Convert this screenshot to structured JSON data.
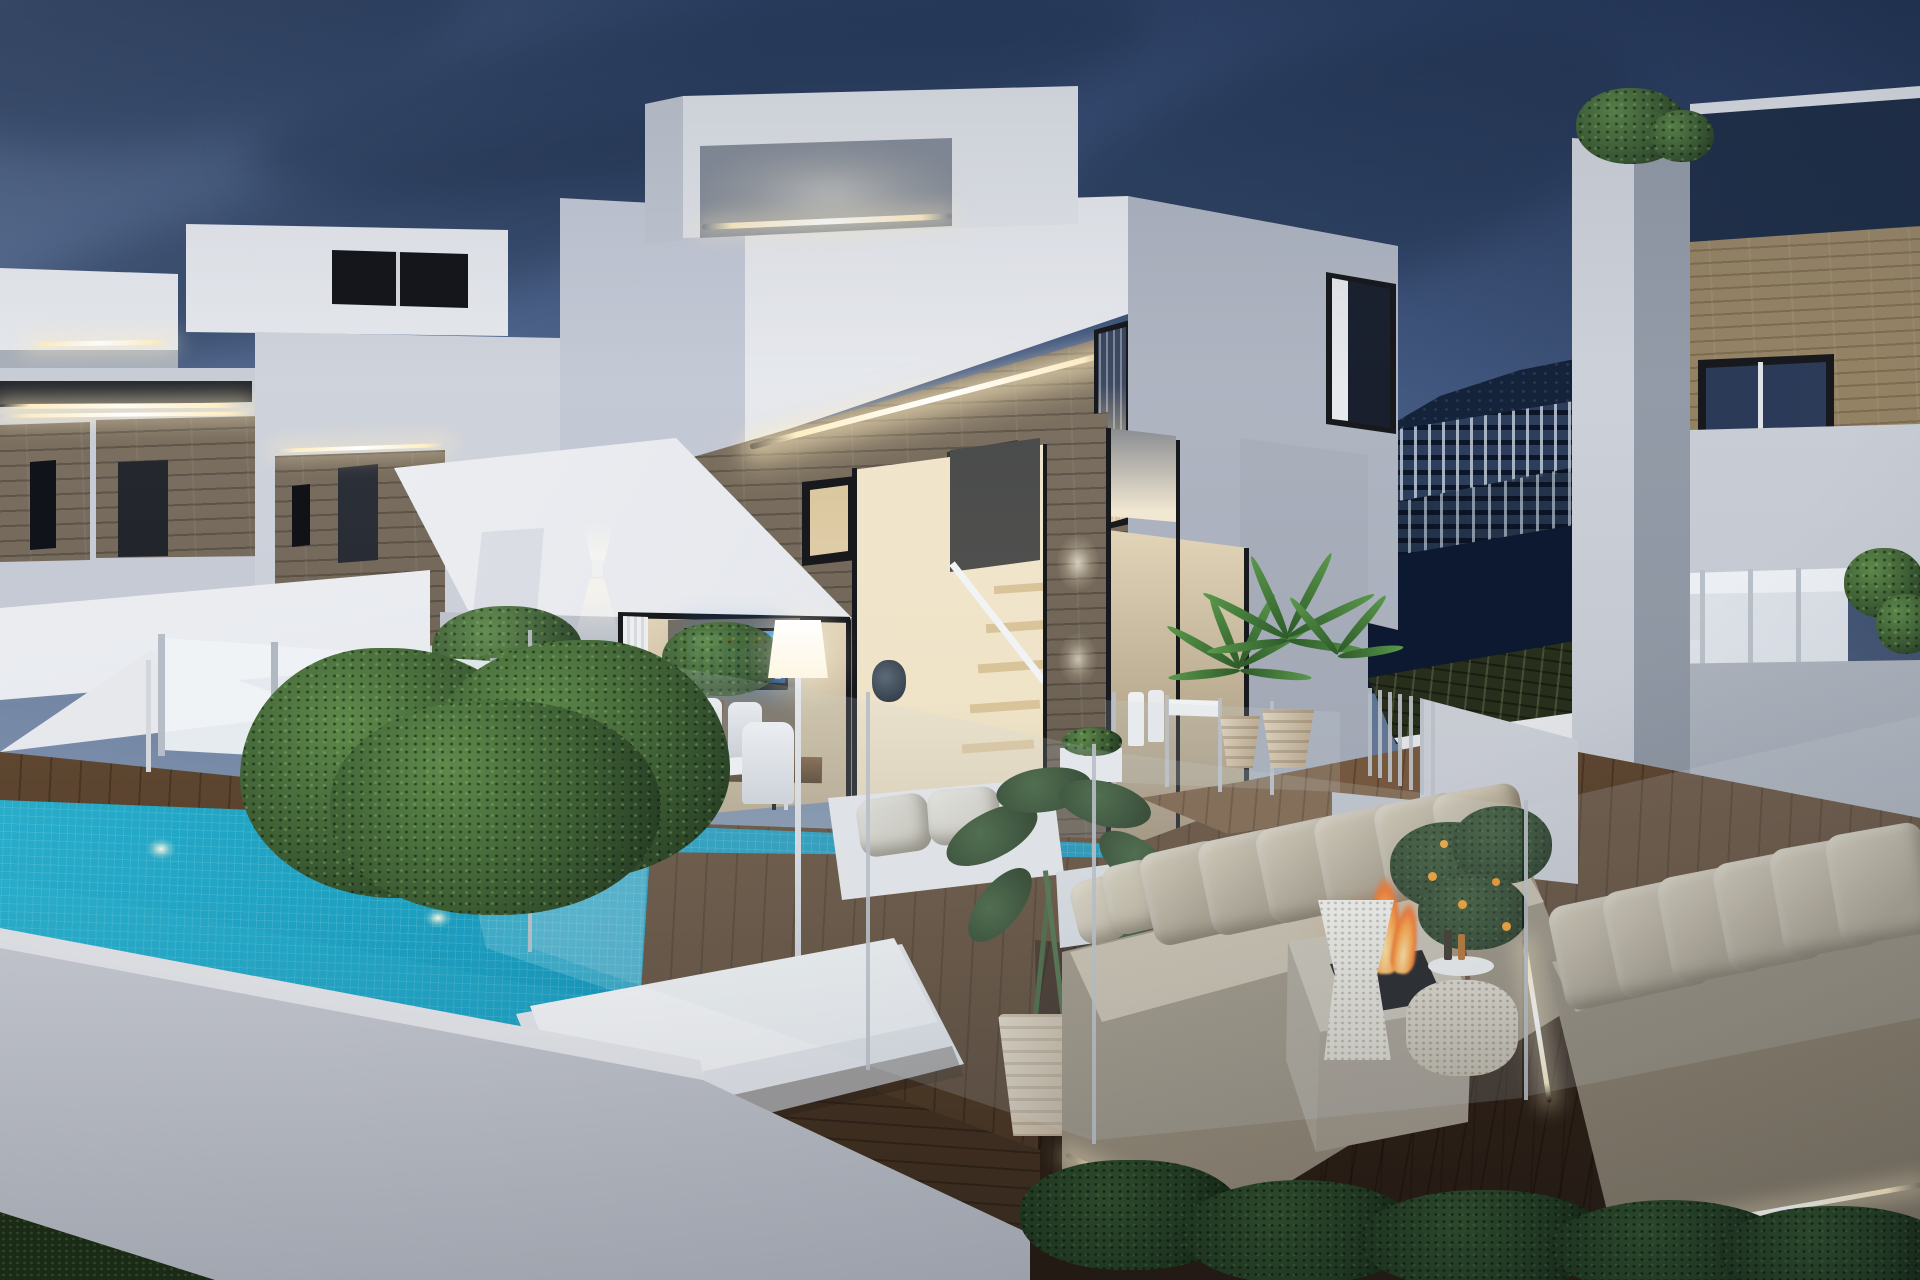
{
  "meta": {
    "title": "Dusk 3D architectural rendering of modern white villas with infinity pool and fire-pit lounge",
    "scene_type": "exterior-architectural-visualization",
    "time_of_day": "dusk"
  },
  "palette": {
    "sky1": "#30456a",
    "sky2": "#49608a",
    "sky3": "#6d82a2",
    "sky4": "#95a2b3",
    "sky5": "#a8afb7",
    "cloud": "#22344f",
    "cloudL": "#8fa2ba",
    "mtn": "#17263f",
    "mtnD": "#0d1930",
    "apt": "#2f4260",
    "aptW": "#cfdbe6",
    "terr": "#2c3520",
    "wL": "#eceef2",
    "wM": "#d6dae2",
    "wS": "#bcc2cc",
    "wD": "#9aa1ae",
    "can": "#f2f3f6",
    "stL": "#8e8271",
    "stM": "#6e6355",
    "stD": "#443a31",
    "wood": "#8c7a5e",
    "led": "#ffeec4",
    "lamp": "#fdf6e3",
    "intW": "#f2e8d2",
    "intD": "#d9c49a",
    "frm": "#17191d",
    "gN": "#25354f",
    "poS": "#2cb3cf",
    "poM": "#1594b8",
    "poD": "#0c7ba1",
    "poF": "#1590b4",
    "dkL": "#8a6b4e",
    "dkM": "#644b35",
    "dkD": "#42301e",
    "wallL": "#e0e2e6",
    "wallM": "#c6c9d0",
    "wallD": "#a9adb6",
    "hgL": "#5f8a4b",
    "hgM": "#3c5c33",
    "hgD": "#203420",
    "grs": "#1c2d14",
    "soil": "#261b11",
    "sfB": "#b9ae9b",
    "sfC": "#a49a86",
    "sfS": "#cfc6b2",
    "potL": "#dcd2c0",
    "potD": "#b3a48c",
    "fpC": "#cfc8ba",
    "fpF": "#b2aa9b",
    "flO": "#f26a1c",
    "flM": "#ff9d33",
    "flC": "#ffe2a0",
    "tv": "#1b6fd0",
    "steel": "#b8bfc7",
    "gTint": "rgba(205,215,224,0.18)"
  },
  "scene": {
    "objects": [
      "dusk-sky",
      "cloud-bank",
      "mountain-ridge",
      "hillside-apartments",
      "terraced-fields",
      "left-villa-rooftop-box",
      "left-villa-led-strip",
      "left-villa-stone-wall",
      "left-villa-canopy",
      "patio-umbrella",
      "frosted-glass-fence",
      "main-villa-rooftop-box",
      "main-villa-parapet",
      "main-villa-stone-band",
      "main-villa-led-strip",
      "main-villa-canopy",
      "angled-column",
      "wall-sconce",
      "sliding-glass-doors",
      "smart-tv",
      "interior-staircase",
      "stone-column",
      "downlights",
      "corner-window",
      "right-face-window",
      "right-villa-pillar",
      "right-villa-wood-fascia",
      "right-villa-glass-parapet",
      "right-villa-window-band",
      "wood-deck",
      "entrance-deck",
      "sunken-lounge-deck",
      "deck-steps",
      "stair-balustrade",
      "infinity-pool",
      "pool-mosaic",
      "underwater-lights",
      "pool-tile-face",
      "perimeter-wall",
      "boxwood-hedge",
      "garden-hedgerow",
      "lawn",
      "soil-bed",
      "outdoor-dining-set",
      "floor-lamp",
      "lantern-bags",
      "double-sun-lounger",
      "lounge-sofa-white",
      "olive-trees",
      "potted-palms",
      "alocasia-plant",
      "citrus-tree",
      "planter-boxes",
      "outdoor-sofa-center",
      "outdoor-sofa-right",
      "fire-pit",
      "flames",
      "wicker-side-table",
      "wicker-coffee-table",
      "glass-balustrade",
      "led-deck-lighting"
    ]
  }
}
